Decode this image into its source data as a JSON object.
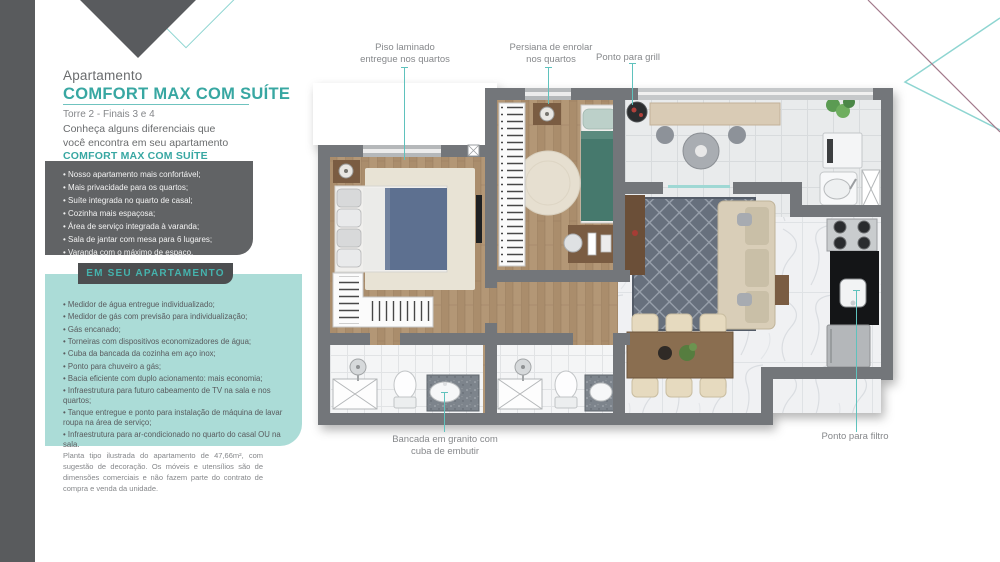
{
  "colors": {
    "accent_teal": "#38a7a2",
    "callout_line_teal": "#5fc2bd",
    "sidebar_bar_gray": "#595b5d",
    "features_box_gray": "#616365",
    "ribbon_gray": "#4c4e50",
    "amenities_mint": "#abdcd7",
    "wall_gray": "#73767a",
    "text_gray": "#6a6c6e"
  },
  "sidebar": {
    "eyebrow": "Apartamento",
    "title": "COMFORT MAX COM SUÍTE",
    "subtitle": "Torre 2 - Finais 3 e 4",
    "intro": "Conheça alguns diferenciais que\nvocê encontra em seu apartamento",
    "intro_highlight": "COMFORT MAX COM SUÍTE",
    "features": [
      "Nosso apartamento mais confortável;",
      "Mais privacidade para os quartos;",
      "Suíte integrada no quarto de casal;",
      "Cozinha mais espaçosa;",
      "Área de serviço integrada à varanda;",
      "Sala de jantar com mesa para 6 lugares;",
      "Varanda com o máximo de espaço."
    ],
    "section_label": "EM SEU APARTAMENTO",
    "amenities": [
      "Medidor de água entregue individualizado;",
      "Medidor de gás com previsão para individualização;",
      "Gás encanado;",
      "Torneiras com dispositivos economizadores de água;",
      "Cuba da bancada da cozinha em aço inox;",
      "Ponto para chuveiro a gás;",
      "Bacia eficiente com duplo acionamento: mais economia;",
      "Infraestrutura para futuro cabeamento de TV na sala e nos quartos;",
      "Tanque entregue e ponto para instalação de máquina de lavar roupa na área de serviço;",
      "Infraestrutura para ar-condicionado no quarto do casal OU na sala."
    ],
    "disclaimer": "Planta tipo ilustrada do apartamento de 47,66m², com sugestão de decoração. Os móveis e utensílios são de dimensões comerciais e não fazem parte do contrato de compra e venda da unidade."
  },
  "floorplan": {
    "callouts": {
      "piso": {
        "label": "Piso laminado\nentregue nos quartos"
      },
      "persiana": {
        "label": "Persiana de enrolar\nnos quartos"
      },
      "grill": {
        "label": "Ponto para grill"
      },
      "bancada": {
        "label": "Bancada em granito com\ncuba de embutir"
      },
      "filtro": {
        "label": "Ponto para filtro"
      }
    }
  }
}
